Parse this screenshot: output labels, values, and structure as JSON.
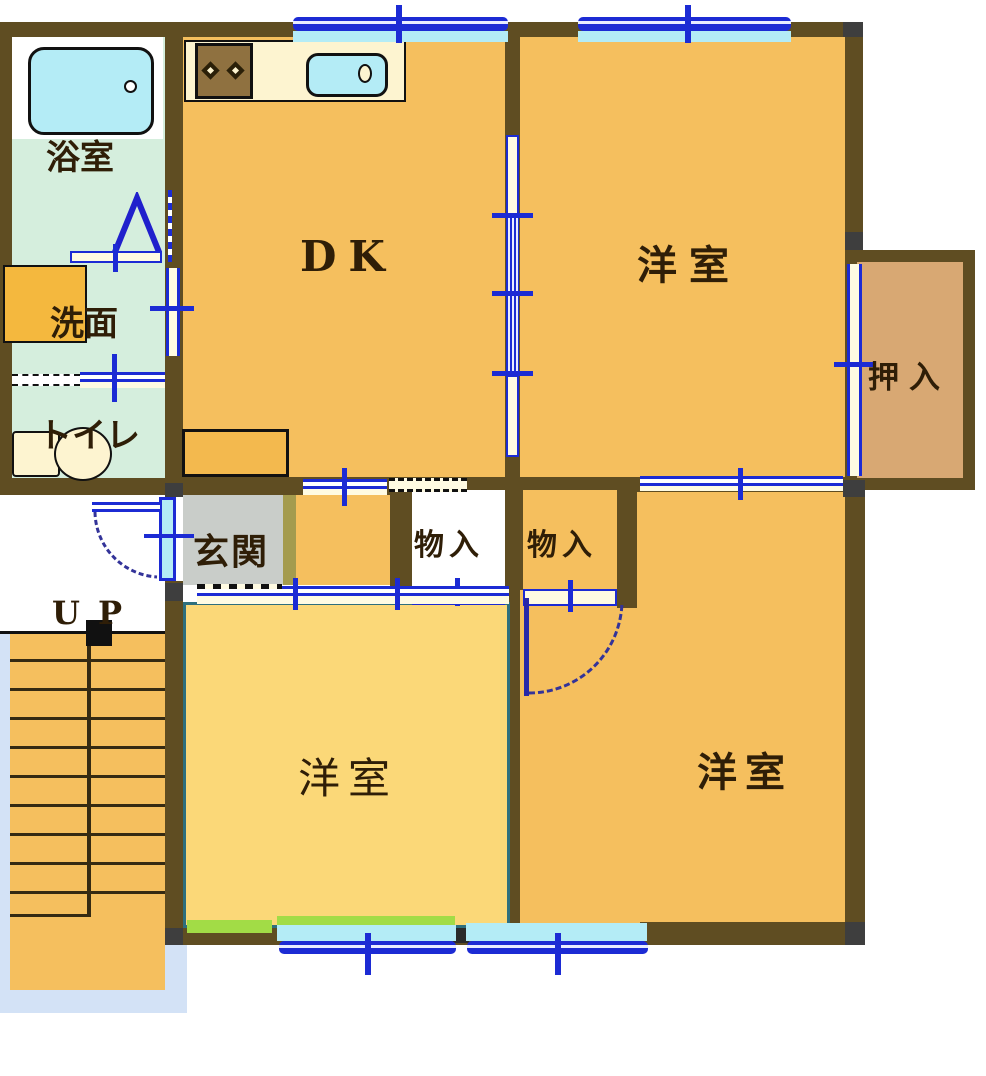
{
  "rooms": {
    "bathroom": {
      "label": "浴室"
    },
    "washroom": {
      "label": "洗面"
    },
    "toilet_room": {
      "label": "トイレ"
    },
    "dining_kitchen": {
      "label": "DK"
    },
    "bedroom_top_right": {
      "label": "洋室"
    },
    "closet_oshiire": {
      "label": "押入"
    },
    "entrance": {
      "label": "玄関"
    },
    "storage_left": {
      "label": "物入"
    },
    "storage_right": {
      "label": "物入"
    },
    "bedroom_bottom_left": {
      "label": "洋室"
    },
    "bedroom_bottom_right": {
      "label": "洋室"
    }
  },
  "stairs": {
    "up_label_u": "U",
    "up_label_p": "P"
  },
  "colors": {
    "wall": "#5f4d22",
    "corner_gray": "#3e3e3e",
    "floor_orange": "#f5bf5e",
    "floor_yellow": "#fbd878",
    "floor_tan": "#d8a873",
    "floor_pale_green": "#d5eedd",
    "entrance_gray": "#c9cdc9",
    "entrance_step_olive": "#a49b4e",
    "fixture_cyan": "#b4ecf6",
    "window_blue": "#1c2bd4",
    "door_cream": "#fffbe2",
    "counter_cream": "#fdf4d0",
    "balcony_green": "#a2dc46",
    "stair_edge_blue": "#d3e2f6",
    "bedroom_border_teal": "#2e6f7d"
  }
}
